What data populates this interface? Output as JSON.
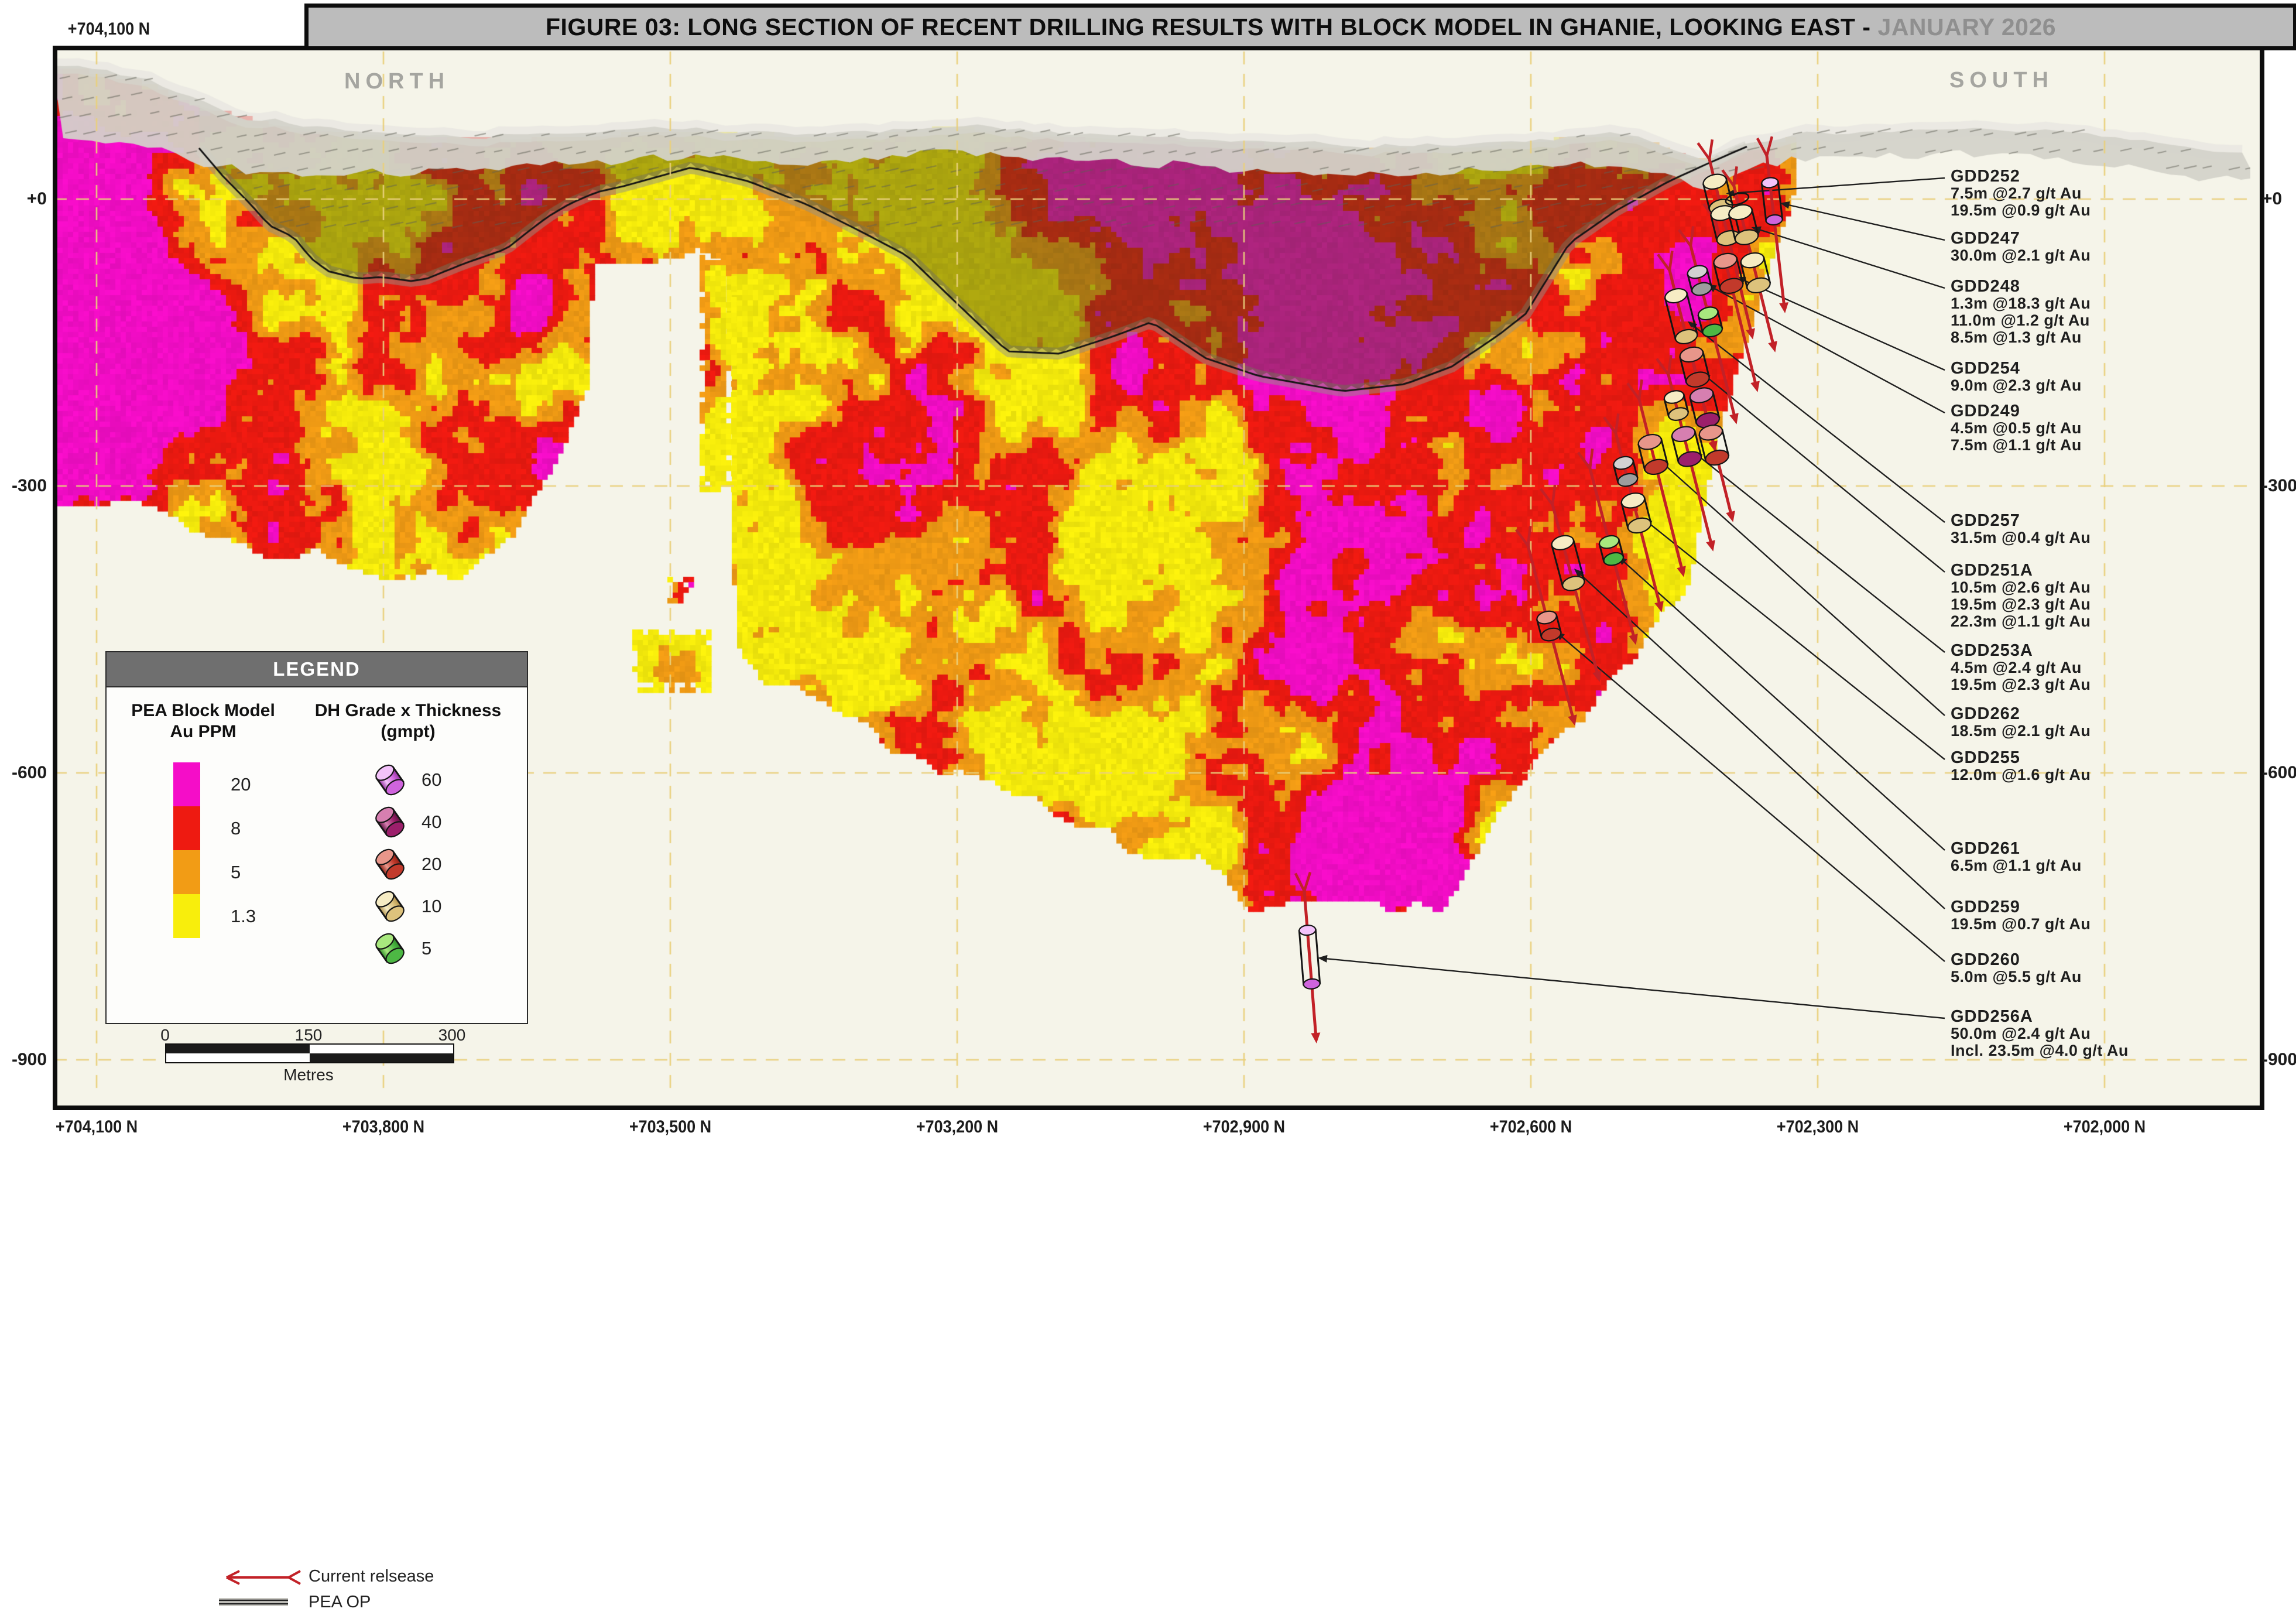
{
  "title": {
    "main": "FIGURE 03: LONG SECTION OF RECENT DRILLING RESULTS WITH BLOCK MODEL IN GHANIE, LOOKING EAST -",
    "date": "JANUARY 2026"
  },
  "compass": {
    "north": "NORTH",
    "south": "SOUTH"
  },
  "axes": {
    "top_left_northing": "+704,100 N",
    "elevation_labels": [
      "+0",
      "-300",
      "-600",
      "-900"
    ],
    "northing_labels": [
      "+704,100 N",
      "+703,800 N",
      "+703,500 N",
      "+703,200 N",
      "+702,900 N",
      "+702,600 N",
      "+702,300 N",
      "+702,000 N"
    ]
  },
  "legend": {
    "header": "LEGEND",
    "block_model": {
      "title_line1": "PEA Block Model",
      "title_line2": "Au PPM",
      "classes": [
        {
          "label": "20",
          "color": "#f50dc8"
        },
        {
          "label": "8",
          "color": "#ee1a11"
        },
        {
          "label": "5",
          "color": "#f29c15"
        },
        {
          "label": "1.3",
          "color": "#f8ee0c"
        }
      ]
    },
    "grade_thickness": {
      "title_line1": "DH Grade x Thickness",
      "title_line2": "(gmpt)",
      "classes": [
        {
          "label": "60",
          "grade": "60"
        },
        {
          "label": "40",
          "grade": "40"
        },
        {
          "label": "20",
          "grade": "20"
        },
        {
          "label": "10",
          "grade": "10"
        },
        {
          "label": "5",
          "grade": "5"
        }
      ]
    },
    "current_release_label": "Current relsease",
    "pea_op_label": "PEA OP"
  },
  "scale_bar": {
    "tick_0": "0",
    "tick_150": "150",
    "tick_300": "300",
    "unit": "Metres"
  },
  "colors": {
    "block_yellow": "#f8ee0c",
    "block_orange": "#f29c15",
    "block_red": "#ee1a11",
    "block_magenta": "#f50dc8",
    "trace_red": "#c22127",
    "gridline": "#e9d07c",
    "terrain_gray": "#d3d2ca",
    "background": "#f5f4e9",
    "title_date_gray": "#8f8f8f",
    "leader_black": "#1f1f1f"
  },
  "cylinder_colors": {
    "60": {
      "base": "#cf64dd",
      "light": "#f3c2fa",
      "dark": "#93309f"
    },
    "40": {
      "base": "#9c1f6b",
      "light": "#d67fb0",
      "dark": "#5f1040"
    },
    "20": {
      "base": "#c23a2b",
      "light": "#e8968a",
      "dark": "#8f1f14"
    },
    "10": {
      "base": "#ddc27c",
      "light": "#f6ecc4",
      "dark": "#b3924a"
    },
    "5": {
      "base": "#4db844",
      "light": "#a8e87e",
      "dark": "#2e8f2a"
    },
    "0": {
      "base": "#9d9d9d",
      "light": "#d2d2d2",
      "dark": "#6e6e6e"
    }
  },
  "section": {
    "holes": [
      {
        "name": "GDD252",
        "intercepts": [
          "7.5m @2.7 g/t Au",
          "19.5m @0.9 g/t Au"
        ],
        "label_y": 302,
        "collar": [
          2920,
          272
        ],
        "end": [
          2992,
          570
        ],
        "markers": [
          {
            "grade": "10",
            "size": "M",
            "t": 0.2
          },
          {
            "grade": "10",
            "size": "M",
            "t": 0.38
          }
        ]
      },
      {
        "name": "GDD247",
        "intercepts": [
          "30.0m @2.1 g/t Au"
        ],
        "label_y": 408,
        "collar": [
          3018,
          266
        ],
        "end": [
          3048,
          525
        ],
        "markers": [
          {
            "grade": "60",
            "size": "XL",
            "t": 0.3
          }
        ]
      },
      {
        "name": "GDD248",
        "intercepts": [
          "1.3m @18.3 g/t Au",
          "11.0m @1.2 g/t Au",
          "8.5m @1.3 g/t Au"
        ],
        "label_y": 490,
        "collar": [
          2962,
          318
        ],
        "end": [
          3030,
          592
        ],
        "markers": [
          {
            "grade": "20",
            "size": "E",
            "t": 0.08
          },
          {
            "grade": "10",
            "size": "M",
            "t": 0.24
          },
          {
            "grade": "10",
            "size": "M",
            "t": 0.54
          }
        ]
      },
      {
        "name": "GDD254",
        "intercepts": [
          "9.0m @2.3 g/t Au"
        ],
        "label_y": 630,
        "collar": [
          2930,
          376
        ],
        "end": [
          3000,
          660
        ],
        "markers": [
          {
            "grade": "20",
            "size": "M",
            "t": 0.32
          }
        ]
      },
      {
        "name": "GDD249",
        "intercepts": [
          "4.5m @0.5 g/t Au",
          "7.5m @1.1 g/t Au"
        ],
        "label_y": 703,
        "collar": [
          2888,
          420
        ],
        "end": [
          2964,
          715
        ],
        "markers": [
          {
            "grade": "0",
            "size": "S",
            "t": 0.2
          },
          {
            "grade": "5",
            "size": "S",
            "t": 0.44
          }
        ]
      },
      {
        "name": "GDD257",
        "intercepts": [
          "31.5m @0.4 g/t Au"
        ],
        "label_y": 890,
        "collar": [
          2852,
          462
        ],
        "end": [
          2928,
          762
        ],
        "markers": [
          {
            "grade": "10",
            "size": "L",
            "t": 0.26
          }
        ]
      },
      {
        "name": "GDD251A",
        "intercepts": [
          "10.5m @2.6 g/t Au",
          "19.5m @2.3 g/t Au",
          "22.3m @1.1 g/t Au"
        ],
        "label_y": 975,
        "collar": [
          2886,
          592
        ],
        "end": [
          2958,
          882
        ],
        "markers": [
          {
            "grade": "20",
            "size": "M",
            "t": 0.12
          },
          {
            "grade": "40",
            "size": "M",
            "t": 0.36
          },
          {
            "grade": "20",
            "size": "M",
            "t": 0.58
          }
        ]
      },
      {
        "name": "GDD253A",
        "intercepts": [
          "4.5m @2.4 g/t Au",
          "19.5m @2.3 g/t Au"
        ],
        "label_y": 1112,
        "collar": [
          2850,
          640
        ],
        "end": [
          2924,
          932
        ],
        "markers": [
          {
            "grade": "10",
            "size": "S",
            "t": 0.18
          },
          {
            "grade": "40",
            "size": "M",
            "t": 0.42
          }
        ]
      },
      {
        "name": "GDD262",
        "intercepts": [
          "18.5m @2.1 g/t Au"
        ],
        "label_y": 1220,
        "collar": [
          2800,
          682
        ],
        "end": [
          2874,
          976
        ],
        "markers": [
          {
            "grade": "20",
            "size": "M",
            "t": 0.32
          }
        ]
      },
      {
        "name": "GDD255",
        "intercepts": [
          "12.0m @1.6 g/t Au"
        ],
        "label_y": 1295,
        "collar": [
          2760,
          740
        ],
        "end": [
          2836,
          1036
        ],
        "markers": [
          {
            "grade": "0",
            "size": "S",
            "t": 0.22
          },
          {
            "grade": "10",
            "size": "M",
            "t": 0.46
          }
        ]
      },
      {
        "name": "GDD261",
        "intercepts": [
          "6.5m @1.1 g/t Au"
        ],
        "label_y": 1450,
        "collar": [
          2716,
          800
        ],
        "end": [
          2792,
          1092
        ],
        "markers": [
          {
            "grade": "5",
            "size": "S",
            "t": 0.48
          }
        ]
      },
      {
        "name": "GDD259",
        "intercepts": [
          "19.5m @0.7 g/t Au"
        ],
        "label_y": 1550,
        "collar": [
          2652,
          862
        ],
        "end": [
          2730,
          1155
        ],
        "markers": [
          {
            "grade": "10",
            "size": "L",
            "t": 0.34
          }
        ]
      },
      {
        "name": "GDD260",
        "intercepts": [
          "5.0m @5.5 g/t Au"
        ],
        "label_y": 1640,
        "collar": [
          2610,
          932
        ],
        "end": [
          2688,
          1230
        ],
        "markers": [
          {
            "grade": "20",
            "size": "S",
            "t": 0.46
          }
        ]
      },
      {
        "name": "GDD256A",
        "intercepts": [
          "50.0m @2.4 g/t Au",
          "Incl. 23.5m @4.0 g/t Au"
        ],
        "label_y": 1737,
        "collar": [
          2228,
          1522
        ],
        "end": [
          2248,
          1772
        ],
        "markers": [
          {
            "grade": "60",
            "size": "XL2",
            "t": 0.45
          }
        ]
      }
    ]
  }
}
